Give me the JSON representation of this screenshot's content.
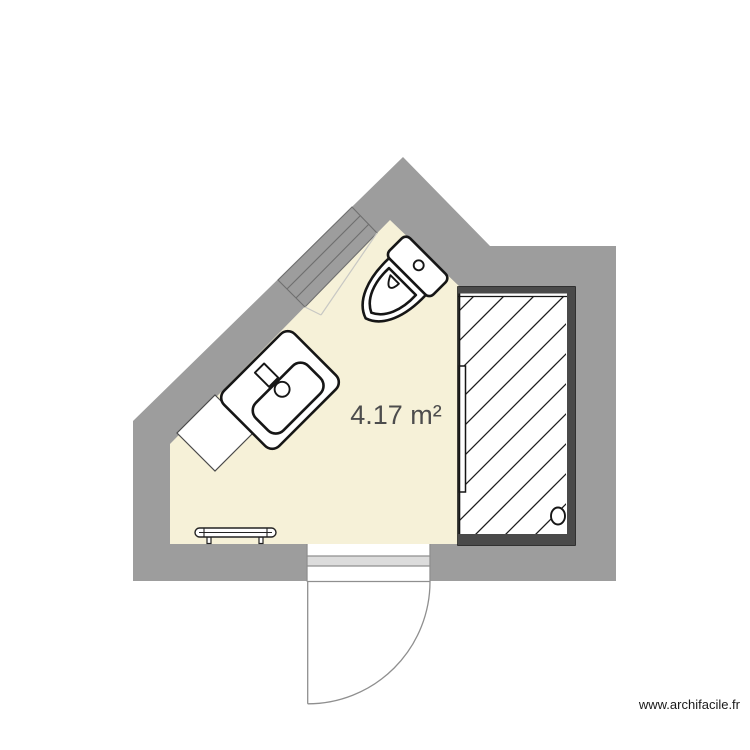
{
  "plan": {
    "area_label": "4.17 m²",
    "watermark": "www.archifacile.fr",
    "colors": {
      "page_background": "#ffffff",
      "wall": "#9d9d9d",
      "floor": "#f6f1d8",
      "shower_frame": "#4a4a4a",
      "door_threshold": "#dcdcdc",
      "area_label": "#4d4d4d",
      "watermark": "#1a1a1a"
    },
    "fixtures": [
      {
        "name": "window",
        "location": "upper-left diagonal wall"
      },
      {
        "name": "toilet",
        "location": "top, against upper-right diagonal wall"
      },
      {
        "name": "washbasin",
        "location": "against upper-left diagonal wall"
      },
      {
        "name": "corner-cabinet",
        "location": "under washbasin"
      },
      {
        "name": "shower",
        "location": "right side"
      },
      {
        "name": "towel-radiator",
        "location": "bottom left"
      },
      {
        "name": "door",
        "location": "bottom wall, swings outward"
      }
    ]
  }
}
